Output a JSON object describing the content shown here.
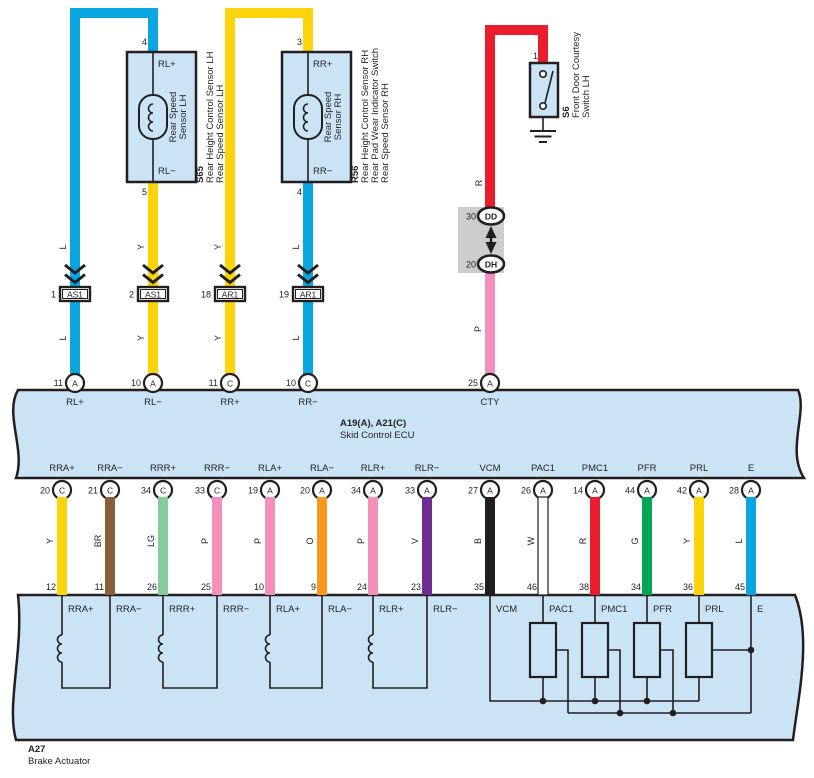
{
  "colors": {
    "L": "#09A6E2",
    "Y": "#FBD40B",
    "R": "#EA1D2C",
    "P": "#F290BB",
    "BR": "#8B5E3B",
    "LG": "#85CB9B",
    "O": "#F79820",
    "V": "#6F2C91",
    "B": "#221E1F",
    "W": "#FFFFFF",
    "G": "#00A651",
    "band_fill": "#CAE4F6",
    "connector_gray": "#CDCDCD",
    "line": "#231F20"
  },
  "sensor_lh": {
    "code": "S65",
    "desc_line1": "Rear Height Control Sensor LH",
    "desc_line2": "Rear Speed Sensor LH",
    "box_line1": "Rear Speed",
    "box_line2": "Sensor LH",
    "pin_top": "4",
    "pin_bottom": "5",
    "term_top": "RL+",
    "term_bottom": "RL−"
  },
  "sensor_rh": {
    "code": "R56",
    "desc_line1": "Rear Height Control Sensor RH",
    "desc_line2": "Rear Pad Wear Indicator Switch",
    "desc_line3": "Rear Speed Sensor RH",
    "box_line1": "Rear Speed",
    "box_line2": "Sensor RH",
    "pin_top": "3",
    "pin_bottom": "4",
    "term_top": "RR+",
    "term_bottom": "RR−"
  },
  "courtesy_switch": {
    "code": "S6",
    "desc_line1": "Front Door Courtesy",
    "desc_line2": "Switch LH",
    "pin": "1"
  },
  "inline_connectors": [
    {
      "num": "1",
      "label": "AS1"
    },
    {
      "num": "2",
      "label": "AS1"
    },
    {
      "num": "18",
      "label": "AR1"
    },
    {
      "num": "19",
      "label": "AR1"
    }
  ],
  "junction": {
    "top_num": "30",
    "top_label": "DD",
    "bottom_num": "20",
    "bottom_label": "DH"
  },
  "top_wire_labels": {
    "w1": "L",
    "w2": "Y",
    "w3": "Y",
    "w4": "L",
    "red": "R",
    "pink": "P"
  },
  "ecu": {
    "title": "A19(A), A21(C)",
    "subtitle": "Skid Control ECU",
    "top_pins": [
      {
        "num": "11",
        "conn": "A",
        "label": "RL+"
      },
      {
        "num": "10",
        "conn": "A",
        "label": "RL−"
      },
      {
        "num": "11",
        "conn": "C",
        "label": "RR+"
      },
      {
        "num": "10",
        "conn": "C",
        "label": "RR−"
      },
      {
        "num": "25",
        "conn": "A",
        "label": "CTY"
      }
    ],
    "bottom_pins": [
      {
        "label": "RRA+",
        "num": "20",
        "conn": "C",
        "color": "Y",
        "act_pin": "12"
      },
      {
        "label": "RRA−",
        "num": "21",
        "conn": "C",
        "color": "BR",
        "act_pin": "11"
      },
      {
        "label": "RRR+",
        "num": "34",
        "conn": "C",
        "color": "LG",
        "act_pin": "26"
      },
      {
        "label": "RRR−",
        "num": "33",
        "conn": "C",
        "color": "P",
        "act_pin": "25"
      },
      {
        "label": "RLA+",
        "num": "19",
        "conn": "A",
        "color": "P",
        "act_pin": "10"
      },
      {
        "label": "RLA−",
        "num": "20",
        "conn": "A",
        "color": "O",
        "act_pin": "9"
      },
      {
        "label": "RLR+",
        "num": "34",
        "conn": "A",
        "color": "P",
        "act_pin": "24"
      },
      {
        "label": "RLR−",
        "num": "33",
        "conn": "A",
        "color": "V",
        "act_pin": "23"
      },
      {
        "label": "VCM",
        "num": "27",
        "conn": "A",
        "color": "B",
        "act_pin": "35"
      },
      {
        "label": "PAC1",
        "num": "26",
        "conn": "A",
        "color": "W",
        "act_pin": "46"
      },
      {
        "label": "PMC1",
        "num": "14",
        "conn": "A",
        "color": "R",
        "act_pin": "38"
      },
      {
        "label": "PFR",
        "num": "44",
        "conn": "A",
        "color": "G",
        "act_pin": "34"
      },
      {
        "label": "PRL",
        "num": "42",
        "conn": "A",
        "color": "Y",
        "act_pin": "36"
      },
      {
        "label": "E",
        "num": "28",
        "conn": "A",
        "color": "L",
        "act_pin": "45"
      }
    ]
  },
  "actuator": {
    "code": "A27",
    "name": "Brake Actuator"
  }
}
